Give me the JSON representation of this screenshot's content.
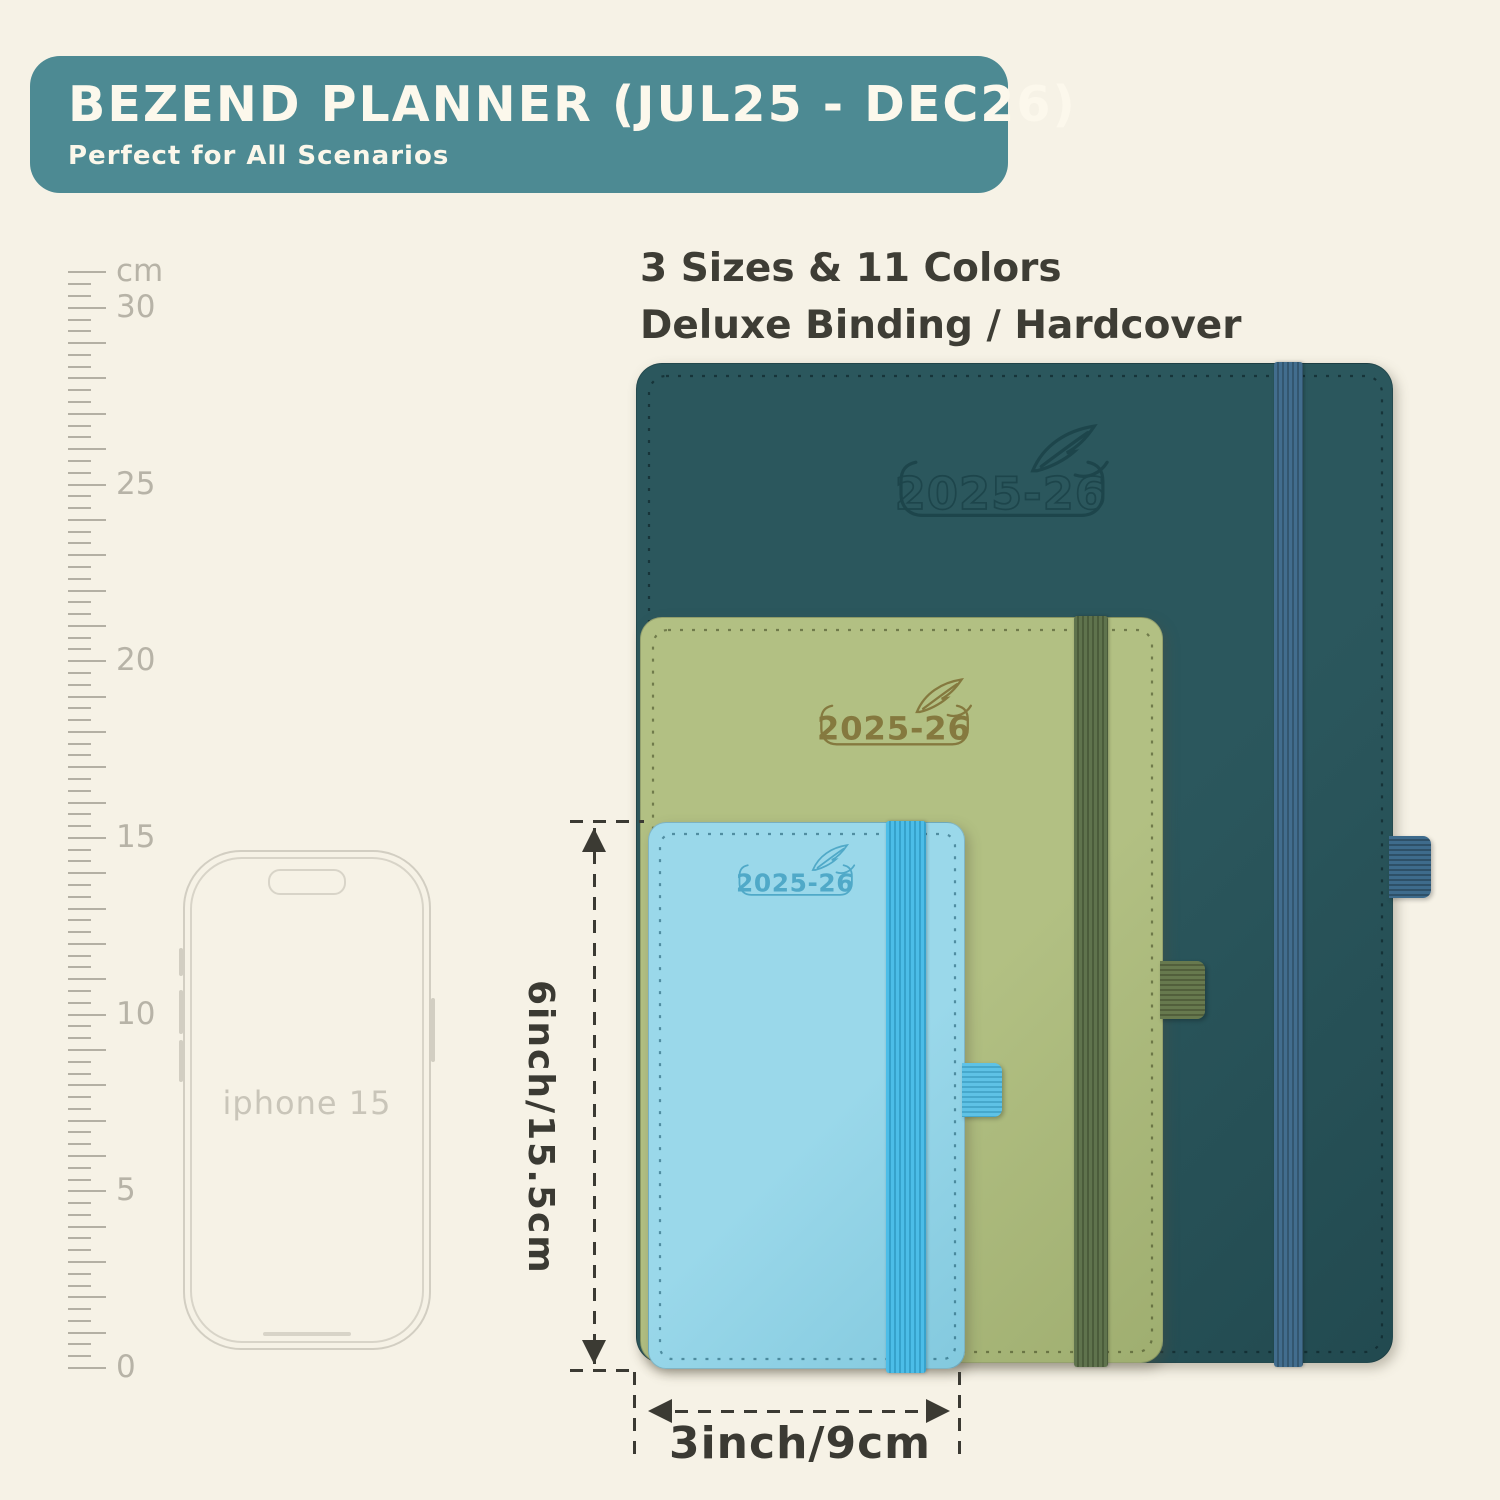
{
  "colors": {
    "background": "#f6f2e6",
    "banner_bg": "#4d8a93",
    "banner_text": "#fcf8ec",
    "headline_text": "#3e3d35",
    "dimension_lines": "#3b3a33",
    "ruler": "#b4b0a4",
    "phone_outline": "#d2cec2"
  },
  "banner": {
    "title": "BEZEND PLANNER (JUL25 - DEC26)",
    "subtitle": "Perfect for All Scenarios"
  },
  "headline": {
    "line1": "3 Sizes & 11 Colors",
    "line2": "Deluxe Binding / Hardcover"
  },
  "ruler": {
    "unit_label": "cm",
    "tick_labels": [
      "0",
      "5",
      "10",
      "15",
      "20",
      "25",
      "30"
    ]
  },
  "phone": {
    "label": "iphone 15"
  },
  "planners": [
    {
      "name": "large teal planner",
      "year": "2025-26",
      "cover": "#2b575d",
      "cover_dark": "#224a50",
      "band": "#426d8e",
      "band_dark": "#33566f",
      "loop": "#3e6b8c",
      "loop_dark": "#2e5068",
      "logo": "#1d454b",
      "stitch": "rgba(12,34,38,0.65)"
    },
    {
      "name": "medium green planner",
      "year": "2025-26",
      "cover": "#b2c083",
      "cover_dark": "#9fae70",
      "band": "#5f734d",
      "band_dark": "#4b5c3b",
      "loop": "#67794e",
      "loop_dark": "#525f3c",
      "logo": "#85793f",
      "stitch": "rgba(58,66,30,0.55)"
    },
    {
      "name": "small blue planner",
      "year": "2025-26",
      "cover": "#9ad8ea",
      "cover_dark": "#83c9de",
      "band": "#4cbde8",
      "band_dark": "#36a2cc",
      "loop": "#5ec2e6",
      "loop_dark": "#46a8cc",
      "logo": "#50a9c8",
      "stitch": "rgba(20,80,100,0.55)"
    }
  ],
  "dimensions": {
    "height_label": "6inch/15.5cm",
    "width_label": "3inch/9cm"
  }
}
